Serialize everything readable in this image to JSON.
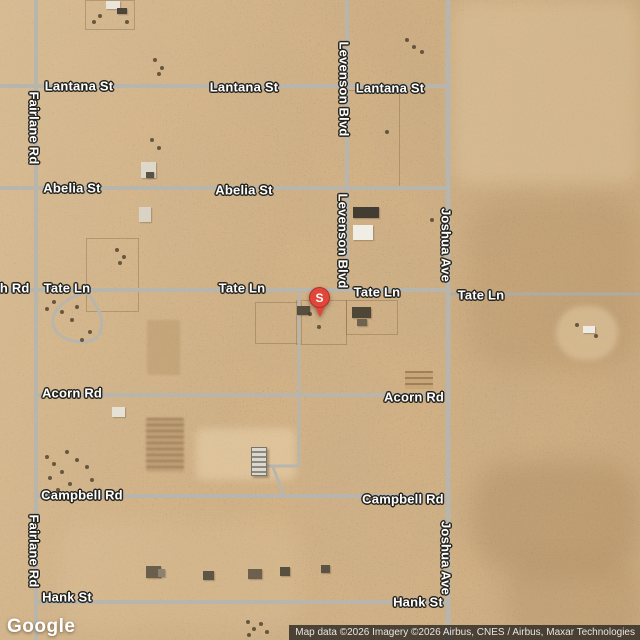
{
  "map": {
    "marker": {
      "label": "S",
      "x": 320,
      "y": 298,
      "color": "#e2463a"
    },
    "google_logo": "Google",
    "attribution": "Map data ©2026 Imagery ©2026 Airbus, CNES / Airbus, Maxar Technologies",
    "labels": [
      {
        "text": "Lantana St",
        "x": 79,
        "y": 86
      },
      {
        "text": "Lantana St",
        "x": 244,
        "y": 87
      },
      {
        "text": "Lantana St",
        "x": 390,
        "y": 88
      },
      {
        "text": "Abelia St",
        "x": 72,
        "y": 188
      },
      {
        "text": "Abelia St",
        "x": 244,
        "y": 190
      },
      {
        "text": "sh Rd",
        "x": 11,
        "y": 288
      },
      {
        "text": "Tate Ln",
        "x": 67,
        "y": 288
      },
      {
        "text": "Tate Ln",
        "x": 242,
        "y": 288
      },
      {
        "text": "Tate Ln",
        "x": 377,
        "y": 292
      },
      {
        "text": "Tate Ln",
        "x": 481,
        "y": 295
      },
      {
        "text": "Acorn Rd",
        "x": 72,
        "y": 393
      },
      {
        "text": "Acorn Rd",
        "x": 414,
        "y": 397
      },
      {
        "text": "Campbell Rd",
        "x": 82,
        "y": 495
      },
      {
        "text": "Campbell Rd",
        "x": 403,
        "y": 499
      },
      {
        "text": "Hank St",
        "x": 67,
        "y": 597
      },
      {
        "text": "Hank St",
        "x": 418,
        "y": 602
      },
      {
        "text": "Fairlane Rd",
        "x": 34,
        "y": 128,
        "vertical": true
      },
      {
        "text": "Fairlane Rd",
        "x": 34,
        "y": 551,
        "vertical": true
      },
      {
        "text": "Levenson Blvd",
        "x": 344,
        "y": 89,
        "vertical": true
      },
      {
        "text": "Levenson Blvd",
        "x": 343,
        "y": 241,
        "vertical": true
      },
      {
        "text": "Joshua Ave",
        "x": 446,
        "y": 245,
        "vertical": true
      },
      {
        "text": "Joshua Ave",
        "x": 446,
        "y": 558,
        "vertical": true
      }
    ],
    "roads": {
      "color": "#b8b5ac",
      "segments": [
        {
          "x1": 0,
          "y1": 86,
          "x2": 450,
          "y2": 86,
          "w": 4
        },
        {
          "x1": 0,
          "y1": 188,
          "x2": 450,
          "y2": 188,
          "w": 4
        },
        {
          "x1": 0,
          "y1": 290,
          "x2": 450,
          "y2": 290,
          "w": 4
        },
        {
          "x1": 448,
          "y1": 294,
          "x2": 640,
          "y2": 294,
          "w": 3,
          "color": "#aeaba2"
        },
        {
          "x1": 36,
          "y1": 395,
          "x2": 450,
          "y2": 395,
          "w": 4
        },
        {
          "x1": 36,
          "y1": 496,
          "x2": 450,
          "y2": 496,
          "w": 4
        },
        {
          "x1": 36,
          "y1": 602,
          "x2": 450,
          "y2": 602,
          "w": 4
        },
        {
          "x1": 36,
          "y1": 0,
          "x2": 36,
          "y2": 640,
          "w": 4
        },
        {
          "x1": 347,
          "y1": 0,
          "x2": 347,
          "y2": 290,
          "w": 4
        },
        {
          "x1": 448,
          "y1": 0,
          "x2": 448,
          "y2": 640,
          "w": 5
        },
        {
          "x1": 299,
          "y1": 290,
          "x2": 299,
          "y2": 466,
          "w": 3
        },
        {
          "x1": 264,
          "y1": 466,
          "x2": 300,
          "y2": 466,
          "w": 3
        },
        {
          "x1": 273,
          "y1": 467,
          "x2": 284,
          "y2": 496,
          "w": 3
        }
      ],
      "paths": [
        {
          "d": "M86,292 C60,300 46,316 56,331 C64,343 94,347 100,333 C106,318 96,303 86,292",
          "w": 3
        }
      ]
    },
    "terrain": {
      "sand_color": "#d3b286",
      "parcels": [
        {
          "x": 85,
          "y": 0,
          "w": 48,
          "h": 28
        },
        {
          "x": 86,
          "y": 238,
          "w": 51,
          "h": 72
        },
        {
          "x": 296,
          "y": 300,
          "w": 49,
          "h": 43
        },
        {
          "x": 346,
          "y": 90,
          "w": 52,
          "h": 98
        },
        {
          "x": 255,
          "y": 302,
          "w": 45,
          "h": 40
        },
        {
          "x": 346,
          "y": 300,
          "w": 50,
          "h": 33
        }
      ],
      "patches": [
        {
          "x": 452,
          "y": 0,
          "w": 188,
          "h": 185,
          "bg": "rgba(226,202,164,0.40)",
          "blur": 8,
          "r": 20
        },
        {
          "x": 468,
          "y": 198,
          "w": 172,
          "h": 170,
          "bg": "rgba(150,112,70,0.16)",
          "blur": 12,
          "r": 40
        },
        {
          "x": 472,
          "y": 462,
          "w": 168,
          "h": 110,
          "bg": "rgba(140,104,64,0.22)",
          "blur": 12,
          "r": 40
        },
        {
          "x": 505,
          "y": 560,
          "w": 135,
          "h": 80,
          "bg": "rgba(150,115,75,0.18)",
          "blur": 10,
          "r": 30
        },
        {
          "x": 60,
          "y": 520,
          "w": 240,
          "h": 110,
          "bg": "rgba(222,198,160,0.25)",
          "blur": 10,
          "r": 30
        },
        {
          "x": 196,
          "y": 428,
          "w": 100,
          "h": 52,
          "bg": "rgba(235,214,176,0.50)",
          "blur": 4,
          "r": 8
        },
        {
          "x": 556,
          "y": 306,
          "w": 62,
          "h": 54,
          "bg": "rgba(226,202,162,0.55)",
          "blur": 3,
          "r": 50
        },
        {
          "x": 147,
          "y": 320,
          "w": 33,
          "h": 55,
          "bg": "rgba(170,135,90,0.30)",
          "blur": 1,
          "r": 2
        },
        {
          "x": 146,
          "y": 418,
          "w": 38,
          "h": 54,
          "bg": "rgba(165,130,88,0.35)",
          "blur": 1,
          "r": 2,
          "stripes": true
        },
        {
          "x": 405,
          "y": 371,
          "w": 28,
          "h": 18,
          "bg": "rgba(190,155,105,0.45)",
          "blur": 0,
          "r": 1,
          "stripes": true
        }
      ],
      "buildings": [
        {
          "x": 106,
          "y": 1,
          "w": 14,
          "h": 8,
          "c": "#e9e5da"
        },
        {
          "x": 117,
          "y": 8,
          "w": 10,
          "h": 6,
          "c": "#4d453a"
        },
        {
          "x": 141,
          "y": 162,
          "w": 15,
          "h": 16,
          "c": "#ded8cb"
        },
        {
          "x": 146,
          "y": 172,
          "w": 8,
          "h": 6,
          "c": "#5a5245"
        },
        {
          "x": 139,
          "y": 207,
          "w": 12,
          "h": 15,
          "c": "#d9d3c5"
        },
        {
          "x": 353,
          "y": 207,
          "w": 26,
          "h": 11,
          "c": "#433c32"
        },
        {
          "x": 353,
          "y": 225,
          "w": 20,
          "h": 15,
          "c": "#f0ede5"
        },
        {
          "x": 297,
          "y": 306,
          "w": 13,
          "h": 9,
          "c": "#564e3e"
        },
        {
          "x": 352,
          "y": 307,
          "w": 19,
          "h": 11,
          "c": "#4e4637"
        },
        {
          "x": 357,
          "y": 319,
          "w": 10,
          "h": 7,
          "c": "#6e6250"
        },
        {
          "x": 112,
          "y": 407,
          "w": 13,
          "h": 10,
          "c": "#e6e1d5"
        },
        {
          "x": 251,
          "y": 447,
          "w": 14,
          "h": 27,
          "c": "greenhouse"
        },
        {
          "x": 583,
          "y": 326,
          "w": 12,
          "h": 7,
          "c": "#edebe3"
        },
        {
          "x": 146,
          "y": 566,
          "w": 15,
          "h": 12,
          "c": "#6a5f4c"
        },
        {
          "x": 158,
          "y": 569,
          "w": 7,
          "h": 8,
          "c": "#8d8270"
        },
        {
          "x": 203,
          "y": 571,
          "w": 11,
          "h": 9,
          "c": "#5f5546"
        },
        {
          "x": 248,
          "y": 569,
          "w": 14,
          "h": 10,
          "c": "#6c614e"
        },
        {
          "x": 280,
          "y": 567,
          "w": 10,
          "h": 9,
          "c": "#57503f"
        },
        {
          "x": 321,
          "y": 565,
          "w": 9,
          "h": 8,
          "c": "#5d5344"
        }
      ],
      "dots": [
        [
          92,
          20
        ],
        [
          125,
          20
        ],
        [
          98,
          14
        ],
        [
          405,
          38
        ],
        [
          412,
          45
        ],
        [
          420,
          50
        ],
        [
          153,
          58
        ],
        [
          160,
          66
        ],
        [
          157,
          72
        ],
        [
          150,
          138
        ],
        [
          157,
          146
        ],
        [
          115,
          248
        ],
        [
          122,
          255
        ],
        [
          118,
          261
        ],
        [
          60,
          310
        ],
        [
          70,
          318
        ],
        [
          75,
          305
        ],
        [
          52,
          300
        ],
        [
          45,
          307
        ],
        [
          88,
          330
        ],
        [
          80,
          338
        ],
        [
          45,
          455
        ],
        [
          52,
          462
        ],
        [
          60,
          470
        ],
        [
          48,
          476
        ],
        [
          68,
          482
        ],
        [
          56,
          488
        ],
        [
          75,
          458
        ],
        [
          85,
          465
        ],
        [
          90,
          478
        ],
        [
          65,
          450
        ],
        [
          246,
          620
        ],
        [
          252,
          627
        ],
        [
          259,
          622
        ],
        [
          247,
          633
        ],
        [
          265,
          630
        ],
        [
          317,
          325
        ],
        [
          308,
          312
        ],
        [
          575,
          323
        ],
        [
          594,
          334
        ],
        [
          385,
          130
        ],
        [
          430,
          218
        ],
        [
          338,
          81
        ]
      ]
    }
  }
}
